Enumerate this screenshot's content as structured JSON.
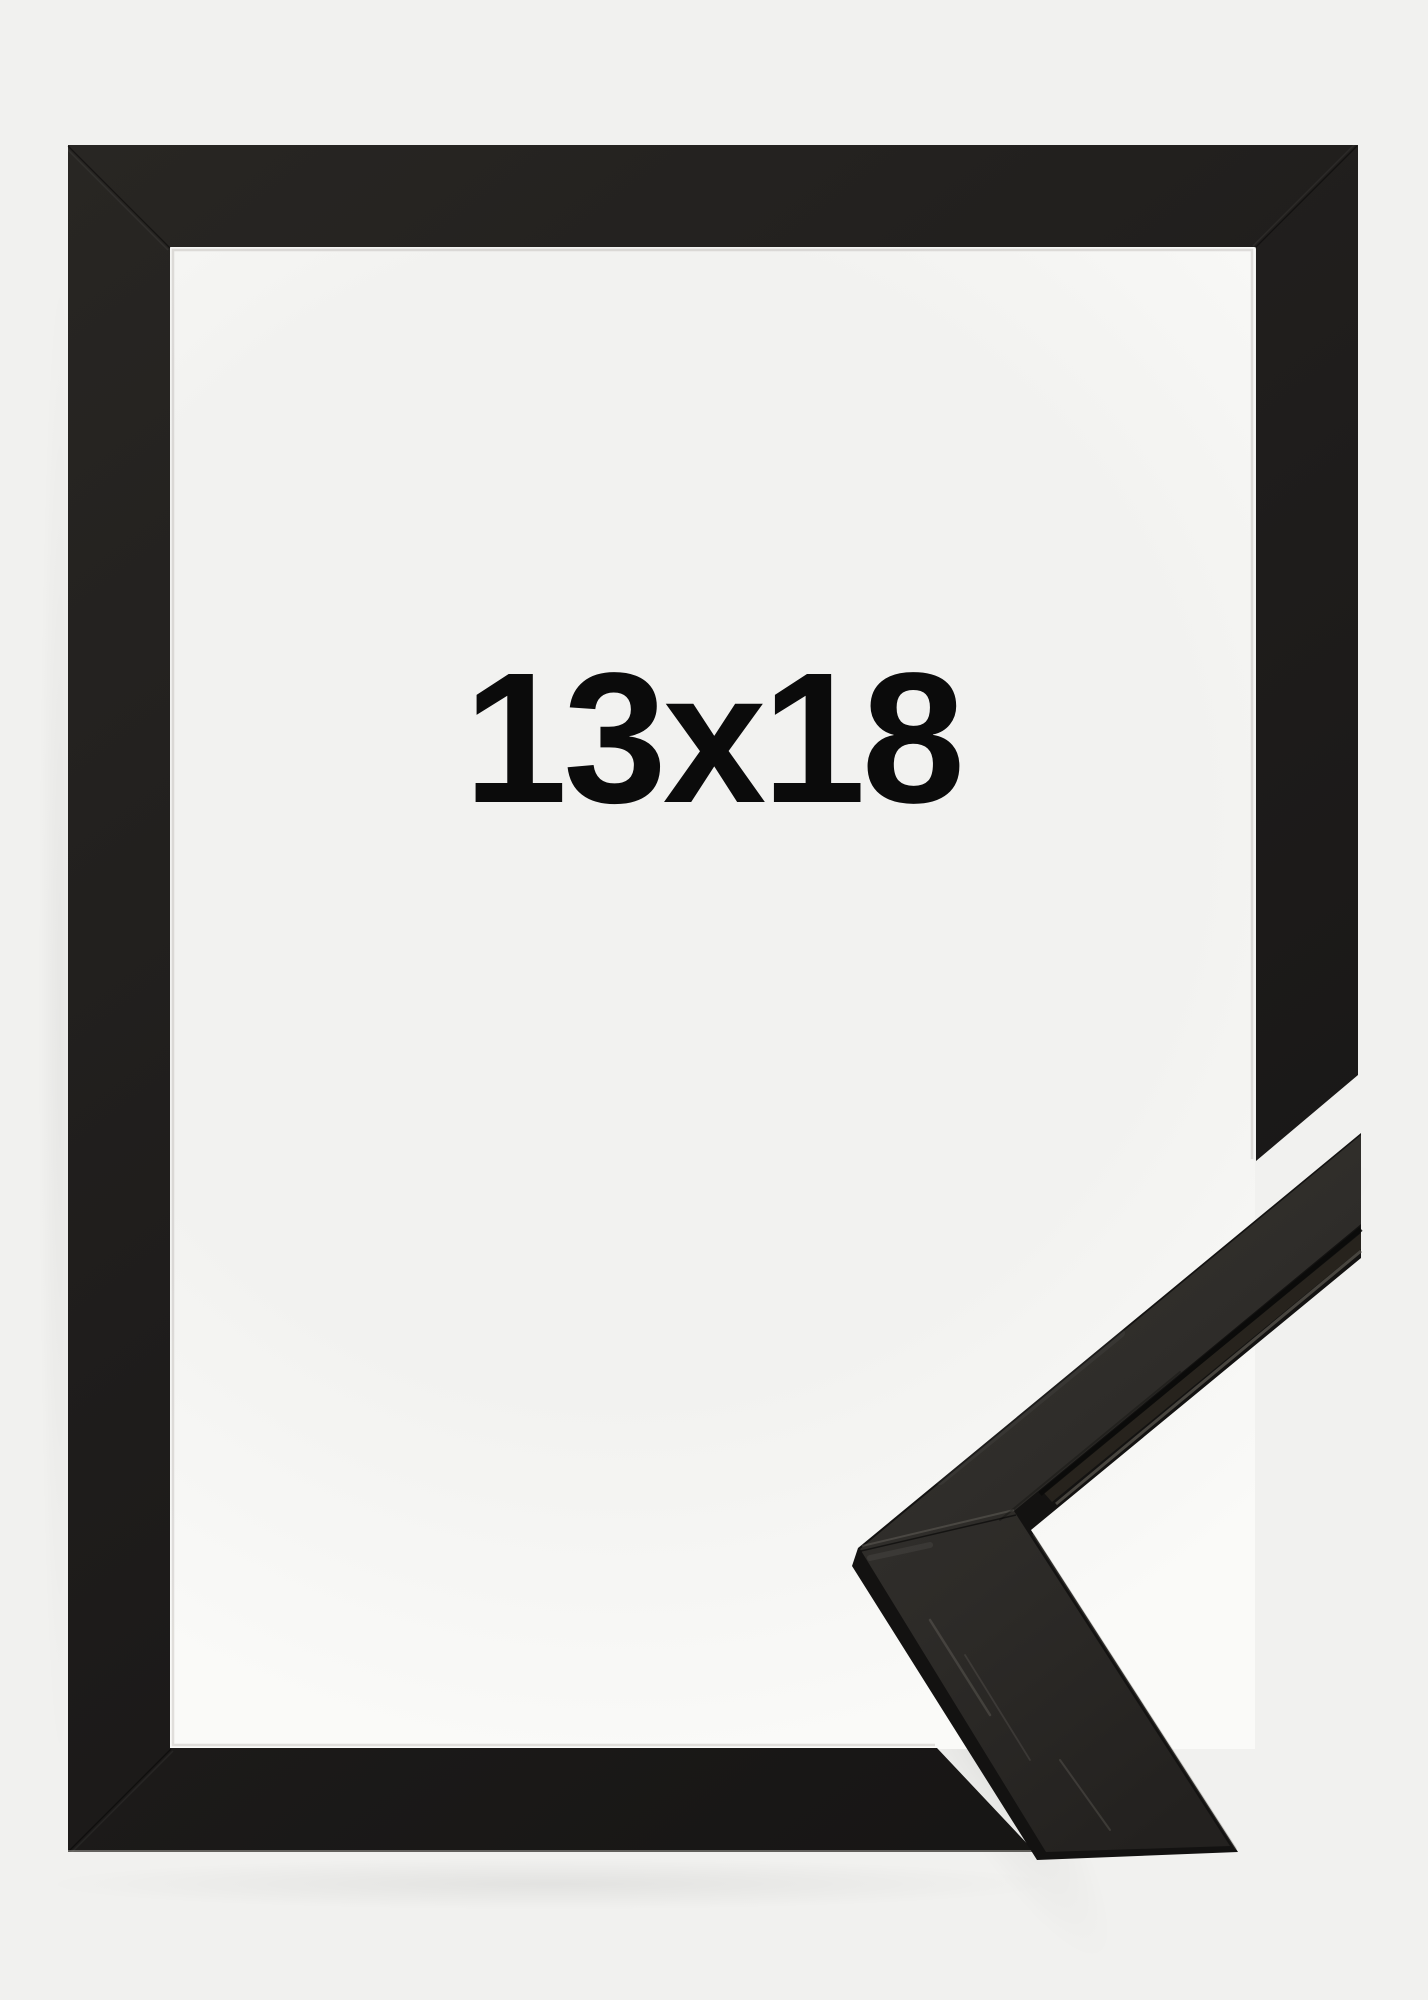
{
  "image": {
    "kind": "product-photo",
    "subject": "black wooden picture frame shown from the front with bottom-right corner cut away and a mitered corner sample of the moulding profile displayed diagonally"
  },
  "label": {
    "text": "13x18"
  },
  "colors": {
    "bg": "#f1f1ef",
    "opening": "#f2f2f0",
    "openingEdge": "#fafaf8",
    "frame": "#1e1c1b",
    "frameLight": "#282623",
    "frameDark": "#151413",
    "sampleFront": "#2d2b28",
    "sampleFrontLight": "#34322e",
    "sampleFrontDark": "#23211f",
    "sampleDark": "#131211",
    "text": "#0b0b0b"
  }
}
